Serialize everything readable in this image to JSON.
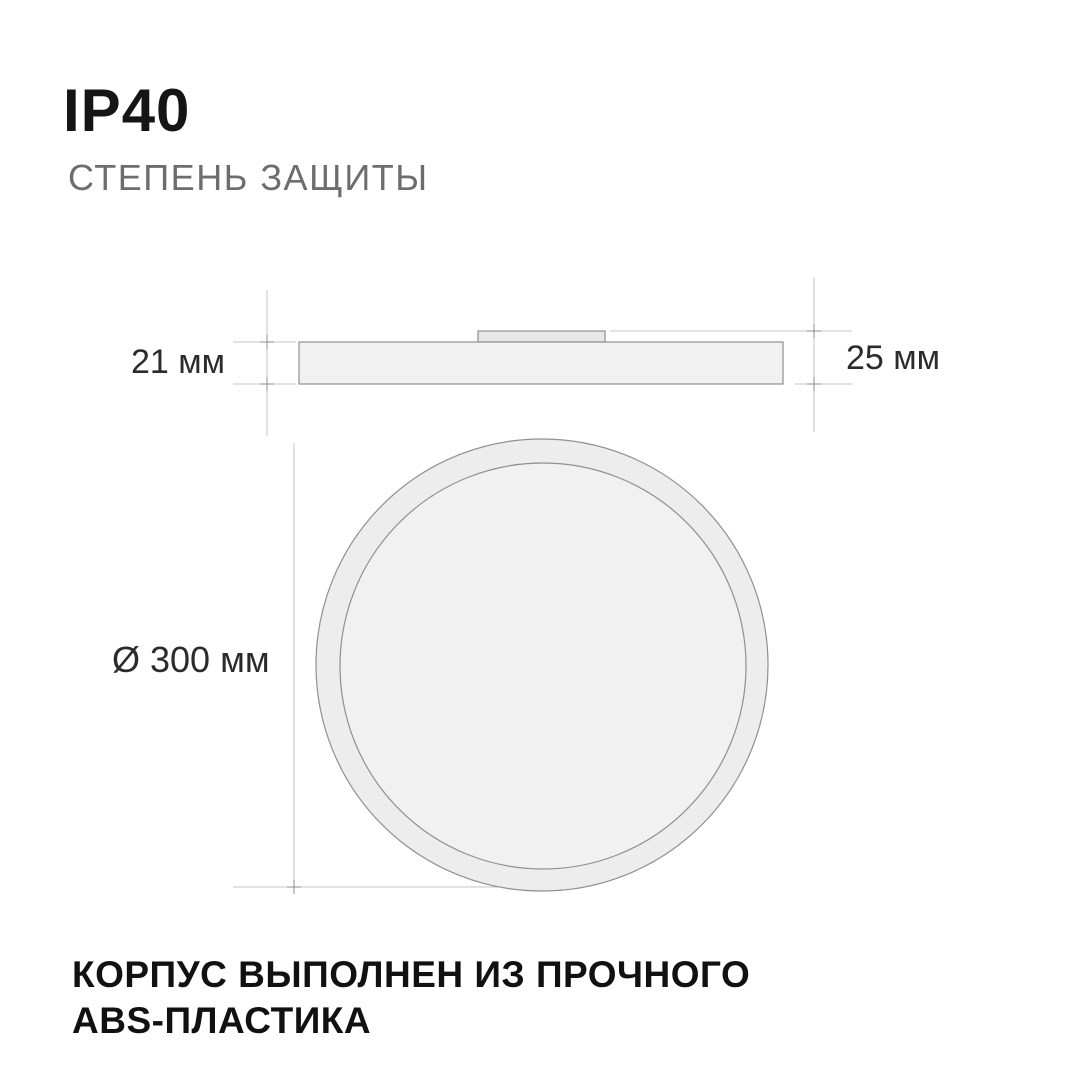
{
  "header": {
    "title": "IP40",
    "subtitle": "СТЕПЕНЬ ЗАЩИТЫ"
  },
  "side_view": {
    "body_height_label": "21 мм",
    "total_height_label": "25 мм"
  },
  "top_view": {
    "diameter_label": "Ø 300 мм"
  },
  "footer": {
    "line1": "КОРПУС ВЫПОЛНЕН ИЗ ПРОЧНОГО",
    "line2": "ABS-ПЛАСТИКА"
  },
  "colors": {
    "background": "#ffffff",
    "title_text": "#151515",
    "subtitle_text": "#6d6d6d",
    "dimension_text": "#2b2b2b",
    "body_fill": "#f1f1f1",
    "ring_fill": "#ededed",
    "plate_fill": "#e8e8e8",
    "shape_stroke": "#909090",
    "dimension_line": "#c5c5c5",
    "tick_mark": "#8e8e8e"
  }
}
